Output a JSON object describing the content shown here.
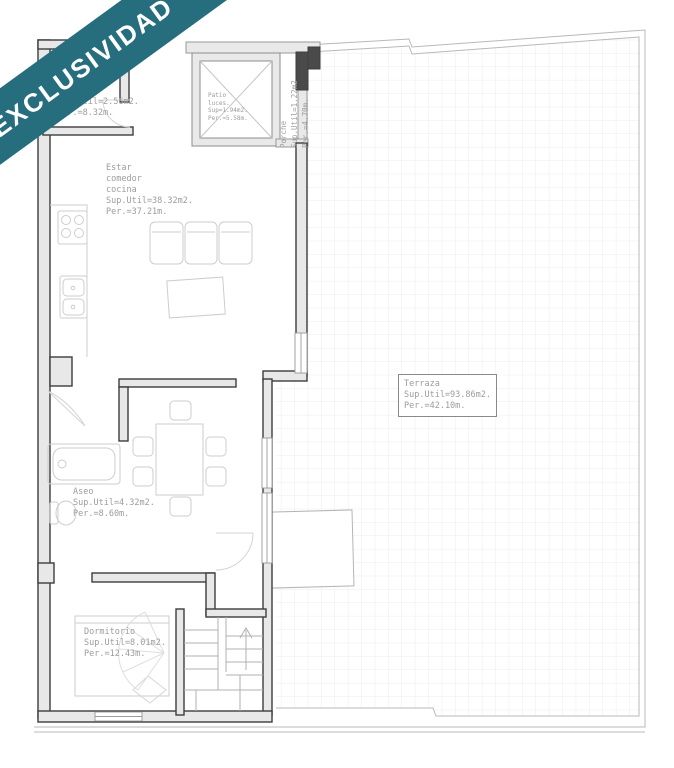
{
  "banner": {
    "label": "EXCLUSIVIDAD"
  },
  "colors": {
    "banner_teal": "#266e7e",
    "wall_dark": "#3d3d3d",
    "wall_fill": "#e8e8e8",
    "label_gray": "#9c9c9c",
    "furniture_gray": "#cdcdcd",
    "tile_grid": "#ececec"
  },
  "plan": {
    "rooms": [
      {
        "id": "room_top",
        "label": "Sup.Util=2.56m2.\nPer.=8.32m."
      },
      {
        "id": "patio",
        "label": "Patio\nluces.\nSup=1.94m2.\nPer.=5.58m."
      },
      {
        "id": "porche",
        "label": "Porche\nSup.Util=1.22m2\nPer.=4.70m."
      },
      {
        "id": "estar",
        "label": "Estar\ncomedor\ncocina\nSup.Util=38.32m2.\nPer.=37.21m."
      },
      {
        "id": "terraza",
        "label": "Terraza\nSup.Util=93.86m2.\nPer.=42.10m."
      },
      {
        "id": "aseo",
        "label": "Aseo\nSup.Util=4.32m2.\nPer.=8.60m."
      },
      {
        "id": "dormitorio",
        "label": "Dormitorio\nSup.Util=8.01m2.\nPer.=12.43m."
      }
    ]
  }
}
